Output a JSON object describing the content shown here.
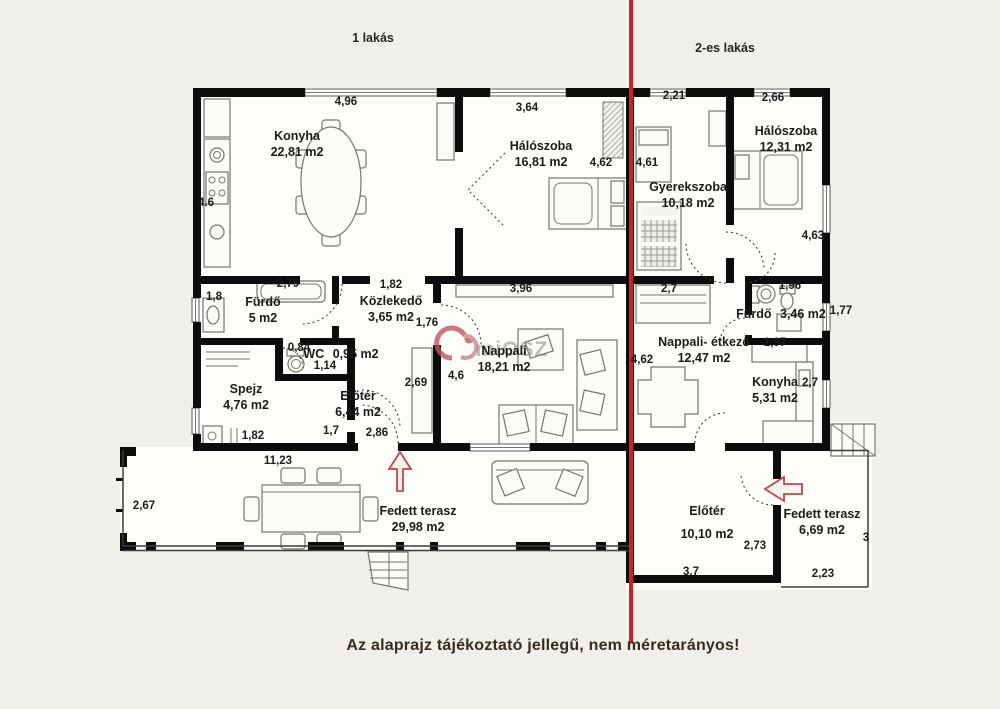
{
  "header": {
    "apt1": "1 lakás",
    "apt2": "2-es lakás"
  },
  "footer": {
    "disclaimer": "Az alaprajz tájékoztató jellegű, nem méretarányos!"
  },
  "watermark": {
    "text": "miOSZ"
  },
  "colors": {
    "red_line": "#cb2127",
    "wall": "#0c0c0c",
    "arrow_red": "#bb4852",
    "background": "#f1efe9"
  },
  "rooms": {
    "konyha1": {
      "name": "Konyha",
      "area": "22,81 m2"
    },
    "haloszoba1": {
      "name": "Hálószoba",
      "area": "16,81 m2"
    },
    "furdo1": {
      "name": "Fürdő",
      "area": "5 m2"
    },
    "kozlekedo": {
      "name": "Közlekedő",
      "area": "3,65 m2"
    },
    "wc": {
      "name": "WC",
      "area": "0,95 m2"
    },
    "spejz": {
      "name": "Spejz",
      "area": "4,76 m2"
    },
    "eloter1": {
      "name": "Előtér",
      "area": "6,44 m2"
    },
    "nappali1": {
      "name": "Nappali",
      "area": "18,21 m2"
    },
    "terasz1": {
      "name": "Fedett terasz",
      "area": "29,98 m2"
    },
    "gyerekszoba": {
      "name": "Gyerekszoba",
      "area": "10,18 m2"
    },
    "haloszoba2": {
      "name": "Hálószoba",
      "area": "12,31 m2"
    },
    "furdo2": {
      "name": "Fürdő",
      "area": "3,46 m2"
    },
    "nappali2": {
      "name": "Nappali- étkező",
      "area": "12,47 m2"
    },
    "konyha2": {
      "name": "Konyha",
      "area": "5,31 m2"
    },
    "eloter2": {
      "name": "Előtér",
      "area": "10,10 m2"
    },
    "terasz2": {
      "name": "Fedett terasz",
      "area": "6,69 m2"
    }
  },
  "dims": [
    {
      "v": "4,96"
    },
    {
      "v": "3,64"
    },
    {
      "v": "2,21"
    },
    {
      "v": "2,66"
    },
    {
      "v": "4.6"
    },
    {
      "v": "4,62"
    },
    {
      "v": "4,61"
    },
    {
      "v": "4,63"
    },
    {
      "v": "2,79"
    },
    {
      "v": "1,82"
    },
    {
      "v": "1,8"
    },
    {
      "v": "3,96"
    },
    {
      "v": "2,7"
    },
    {
      "v": "1,96"
    },
    {
      "v": "1,76"
    },
    {
      "v": "1,77"
    },
    {
      "v": "0,84"
    },
    {
      "v": "1,14"
    },
    {
      "v": "2,69"
    },
    {
      "v": "4,6"
    },
    {
      "v": "4,62"
    },
    {
      "v": "1,97"
    },
    {
      "v": "2,7"
    },
    {
      "v": "1,82"
    },
    {
      "v": "1,7"
    },
    {
      "v": "2,86"
    },
    {
      "v": "11,23"
    },
    {
      "v": "2,67"
    },
    {
      "v": "2,73"
    },
    {
      "v": "3,7"
    },
    {
      "v": "2,23"
    },
    {
      "v": "3"
    }
  ]
}
